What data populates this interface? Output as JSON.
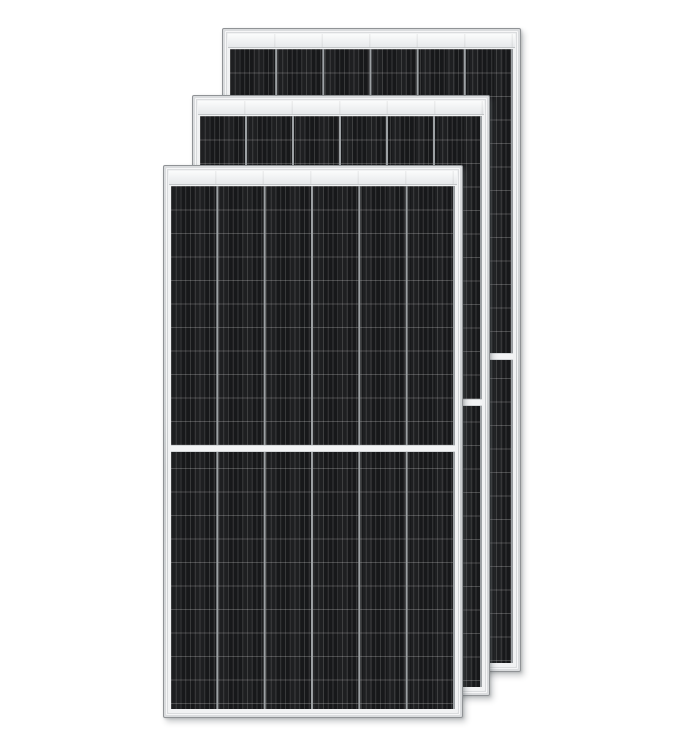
{
  "scene": {
    "type": "product-photo",
    "subject": "Three black solar panels with silver aluminum frames stacked front to back on a white background",
    "panel_count": 3,
    "background_color": "#ffffff"
  },
  "panel_grid": {
    "columns": 6,
    "half_cut_sections": 2,
    "center_divider": "white horizontal gap at vertical midpoint of each panel"
  },
  "panels": [
    {
      "id": "front",
      "position": "front-left, lowest"
    },
    {
      "id": "middle",
      "position": "middle, offset up and right"
    },
    {
      "id": "back",
      "position": "back-right, highest"
    }
  ],
  "colors": {
    "background": "#ffffff",
    "frame_fill": "#ced1d3",
    "frame_fill_light": "#dadcde",
    "frame_edge": "#909396",
    "inner_trim": "#f1f2f3",
    "rail_light": "#fbfcfc",
    "rail_dark": "#e7e9eb",
    "rail_border": "#c2c5c7",
    "cell_base": "#17181a",
    "column_gap": "#9da1a4",
    "divider": "#f3f4f5",
    "divider_edge": "#d5d8da"
  }
}
